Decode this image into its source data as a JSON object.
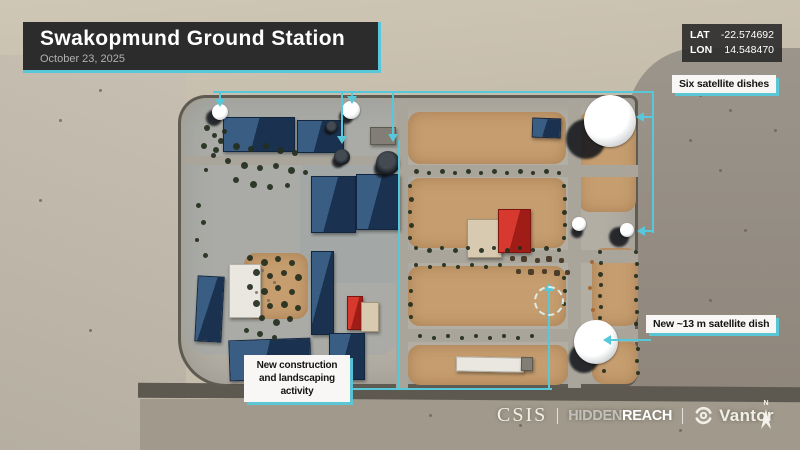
{
  "header": {
    "title": "Swakopmund Ground Station",
    "date": "October 23, 2025"
  },
  "coordinates": {
    "lat_label": "LAT",
    "lat_value": "-22.574692",
    "lon_label": "LON",
    "lon_value": "14.548470"
  },
  "annotations": {
    "six_dishes": "Six satellite dishes",
    "new_dish": "New ~13 m satellite dish",
    "construction": "New construction and landscaping activity"
  },
  "footer": {
    "csis": "CSIS",
    "hidden": "HIDDEN",
    "reach": "REACH",
    "vantor": "Vantor",
    "north": "N"
  },
  "colors": {
    "accent_cyan": "#57c8d9",
    "panel_dark": "#2d2c2d",
    "label_bg": "#f8f7f5",
    "label_text": "#141414",
    "sand": "#c6bdac",
    "desert_gray": "#938d83",
    "pavement": "#b2aea4",
    "dirt": "#c59d6f",
    "roof_blue": "#2a4a6d",
    "roof_red": "#c9291f",
    "road_dark": "#5d5951"
  },
  "map_features": {
    "courtyards": [
      [
        408,
        112,
        158,
        52
      ],
      [
        408,
        178,
        158,
        70
      ],
      [
        408,
        266,
        158,
        60
      ],
      [
        578,
        112,
        58,
        100
      ],
      [
        592,
        248,
        46,
        78
      ],
      [
        592,
        340,
        46,
        44
      ],
      [
        408,
        345,
        160,
        40
      ],
      [
        244,
        253,
        64,
        66
      ]
    ],
    "roads": [
      [
        396,
        100,
        12,
        288
      ],
      [
        568,
        100,
        13,
        288
      ],
      [
        398,
        165,
        240,
        12
      ],
      [
        398,
        250,
        240,
        13
      ],
      [
        398,
        329,
        240,
        13
      ],
      [
        186,
        156,
        212,
        9
      ]
    ],
    "buildings": [
      [
        223,
        117,
        70,
        33,
        "blue",
        0
      ],
      [
        297,
        120,
        45,
        31,
        "blue",
        0
      ],
      [
        311,
        176,
        43,
        55,
        "blue",
        0
      ],
      [
        356,
        174,
        42,
        54,
        "blue",
        0
      ],
      [
        467,
        219,
        33,
        37,
        "beige",
        0
      ],
      [
        498,
        209,
        31,
        42,
        "red",
        0
      ],
      [
        229,
        264,
        30,
        52,
        "white",
        0
      ],
      [
        196,
        276,
        25,
        64,
        "blue",
        3
      ],
      [
        311,
        251,
        21,
        82,
        "blue",
        0
      ],
      [
        347,
        296,
        14,
        32,
        "red",
        0
      ],
      [
        361,
        302,
        16,
        28,
        "beige",
        0
      ],
      [
        229,
        339,
        80,
        39,
        "blue",
        -2
      ],
      [
        329,
        333,
        34,
        45,
        "blue",
        0
      ],
      [
        532,
        118,
        27,
        18,
        "blue",
        2
      ],
      [
        370,
        127,
        24,
        16,
        "gray",
        0
      ],
      [
        456,
        357,
        66,
        13,
        "white",
        1
      ],
      [
        521,
        357,
        10,
        12,
        "gray",
        1
      ]
    ],
    "dishes": [
      [
        220,
        112,
        8,
        "white",
        -6,
        6,
        8
      ],
      [
        351,
        110,
        9,
        "white",
        -5,
        7,
        7
      ],
      [
        332,
        127,
        6,
        "dark",
        -3,
        3,
        5
      ],
      [
        342,
        157,
        8,
        "dark",
        -4,
        5,
        6
      ],
      [
        388,
        163,
        12,
        "dark",
        -5,
        6,
        9
      ],
      [
        610,
        121,
        26,
        "white",
        -24,
        18,
        20
      ],
      [
        627,
        230,
        7,
        "white",
        -8,
        7,
        10
      ],
      [
        596,
        342,
        22,
        "white",
        -12,
        16,
        15
      ],
      [
        579,
        224,
        7,
        "white",
        -2,
        8,
        6
      ]
    ],
    "trees": [
      [
        221,
        141,
        6
      ],
      [
        236,
        146,
        7
      ],
      [
        251,
        149,
        6
      ],
      [
        266,
        146,
        6
      ],
      [
        280,
        150,
        7
      ],
      [
        295,
        153,
        6
      ],
      [
        228,
        161,
        6
      ],
      [
        244,
        165,
        7
      ],
      [
        260,
        168,
        6
      ],
      [
        276,
        166,
        6
      ],
      [
        291,
        170,
        7
      ],
      [
        305,
        172,
        5
      ],
      [
        236,
        180,
        6
      ],
      [
        253,
        184,
        7
      ],
      [
        270,
        187,
        6
      ],
      [
        287,
        185,
        5
      ],
      [
        213,
        155,
        5
      ],
      [
        206,
        170,
        4
      ],
      [
        207,
        128,
        6
      ],
      [
        214,
        135,
        5
      ],
      [
        224,
        131,
        5
      ],
      [
        204,
        146,
        6
      ],
      [
        216,
        150,
        6
      ],
      [
        198,
        205,
        5
      ],
      [
        203,
        222,
        5
      ],
      [
        197,
        240,
        4
      ],
      [
        205,
        255,
        5
      ],
      [
        250,
        258,
        6
      ],
      [
        264,
        262,
        7
      ],
      [
        278,
        259,
        6
      ],
      [
        292,
        263,
        6
      ],
      [
        256,
        272,
        7
      ],
      [
        270,
        276,
        6
      ],
      [
        284,
        273,
        6
      ],
      [
        298,
        277,
        7
      ],
      [
        250,
        287,
        6
      ],
      [
        264,
        291,
        7
      ],
      [
        278,
        288,
        6
      ],
      [
        292,
        292,
        6
      ],
      [
        256,
        303,
        7
      ],
      [
        270,
        306,
        6
      ],
      [
        284,
        304,
        7
      ],
      [
        298,
        308,
        6
      ],
      [
        262,
        318,
        6
      ],
      [
        276,
        322,
        7
      ],
      [
        290,
        319,
        6
      ],
      [
        246,
        330,
        5
      ],
      [
        260,
        334,
        6
      ],
      [
        274,
        337,
        5
      ],
      [
        416,
        171,
        5
      ],
      [
        429,
        173,
        4
      ],
      [
        442,
        171,
        5
      ],
      [
        455,
        173,
        4
      ],
      [
        468,
        171,
        5
      ],
      [
        481,
        173,
        4
      ],
      [
        494,
        171,
        5
      ],
      [
        507,
        173,
        4
      ],
      [
        520,
        171,
        5
      ],
      [
        533,
        173,
        4
      ],
      [
        546,
        171,
        5
      ],
      [
        559,
        173,
        4
      ],
      [
        416,
        248,
        4
      ],
      [
        429,
        250,
        5
      ],
      [
        442,
        248,
        4
      ],
      [
        455,
        250,
        5
      ],
      [
        468,
        248,
        4
      ],
      [
        481,
        250,
        5
      ],
      [
        494,
        248,
        4
      ],
      [
        507,
        250,
        5
      ],
      [
        520,
        248,
        4
      ],
      [
        533,
        250,
        4
      ],
      [
        546,
        248,
        5
      ],
      [
        559,
        250,
        4
      ],
      [
        416,
        265,
        4
      ],
      [
        430,
        267,
        4
      ],
      [
        444,
        265,
        4
      ],
      [
        458,
        267,
        4
      ],
      [
        472,
        265,
        4
      ],
      [
        486,
        267,
        4
      ],
      [
        500,
        265,
        4
      ],
      [
        410,
        186,
        4
      ],
      [
        411,
        199,
        5
      ],
      [
        410,
        212,
        4
      ],
      [
        411,
        225,
        5
      ],
      [
        410,
        238,
        4
      ],
      [
        564,
        186,
        4
      ],
      [
        565,
        199,
        4
      ],
      [
        564,
        212,
        5
      ],
      [
        565,
        225,
        4
      ],
      [
        564,
        238,
        4
      ],
      [
        410,
        278,
        4
      ],
      [
        411,
        291,
        4
      ],
      [
        410,
        304,
        5
      ],
      [
        411,
        317,
        4
      ],
      [
        564,
        278,
        4
      ],
      [
        565,
        291,
        4
      ],
      [
        564,
        304,
        4
      ],
      [
        420,
        336,
        4
      ],
      [
        434,
        338,
        4
      ],
      [
        448,
        336,
        4
      ],
      [
        462,
        338,
        4
      ],
      [
        476,
        336,
        4
      ],
      [
        490,
        338,
        4
      ],
      [
        504,
        336,
        4
      ],
      [
        518,
        338,
        4
      ],
      [
        532,
        336,
        4
      ],
      [
        600,
        252,
        4
      ],
      [
        601,
        263,
        4
      ],
      [
        600,
        274,
        5
      ],
      [
        601,
        285,
        4
      ],
      [
        600,
        296,
        4
      ],
      [
        601,
        307,
        4
      ],
      [
        600,
        318,
        4
      ],
      [
        636,
        252,
        4
      ],
      [
        637,
        264,
        4
      ],
      [
        636,
        276,
        4
      ],
      [
        637,
        288,
        4
      ],
      [
        636,
        300,
        4
      ],
      [
        637,
        312,
        4
      ],
      [
        636,
        324,
        4
      ],
      [
        604,
        349,
        4
      ],
      [
        605,
        360,
        4
      ],
      [
        604,
        371,
        4
      ],
      [
        638,
        349,
        4
      ],
      [
        637,
        361,
        4
      ],
      [
        638,
        373,
        4
      ],
      [
        512,
        258,
        5,
        "equip"
      ],
      [
        524,
        259,
        6,
        "equip"
      ],
      [
        537,
        260,
        5,
        "equip"
      ],
      [
        549,
        259,
        6,
        "equip"
      ],
      [
        561,
        260,
        5,
        "equip"
      ],
      [
        518,
        271,
        5,
        "equip"
      ],
      [
        531,
        272,
        6,
        "equip"
      ],
      [
        544,
        271,
        5,
        "equip"
      ],
      [
        557,
        273,
        6,
        "equip"
      ],
      [
        567,
        272,
        5,
        "equip"
      ],
      [
        592,
        262,
        4,
        "shrub"
      ],
      [
        590,
        288,
        4,
        "shrub"
      ],
      [
        593,
        310,
        4,
        "shrub"
      ],
      [
        608,
        338,
        4,
        "shrub"
      ],
      [
        596,
        354,
        4,
        "shrub"
      ],
      [
        262,
        270,
        3,
        "rock"
      ],
      [
        274,
        282,
        3,
        "rock"
      ],
      [
        256,
        292,
        3,
        "rock"
      ],
      [
        268,
        300,
        3,
        "rock"
      ],
      [
        700,
        95,
        3,
        "rock"
      ],
      [
        730,
        110,
        3,
        "rock"
      ],
      [
        760,
        90,
        3,
        "rock"
      ],
      [
        690,
        140,
        3,
        "rock"
      ],
      [
        720,
        170,
        3,
        "rock"
      ],
      [
        775,
        130,
        3,
        "rock"
      ],
      [
        745,
        230,
        3,
        "rock"
      ],
      [
        710,
        300,
        3,
        "rock"
      ],
      [
        765,
        330,
        3,
        "rock"
      ],
      [
        60,
        120,
        3,
        "rock"
      ],
      [
        100,
        90,
        3,
        "rock"
      ],
      [
        40,
        200,
        3,
        "rock"
      ],
      [
        90,
        330,
        3,
        "rock"
      ],
      [
        430,
        415,
        3,
        "rock"
      ],
      [
        520,
        425,
        3,
        "rock"
      ],
      [
        680,
        430,
        3,
        "rock"
      ]
    ]
  }
}
